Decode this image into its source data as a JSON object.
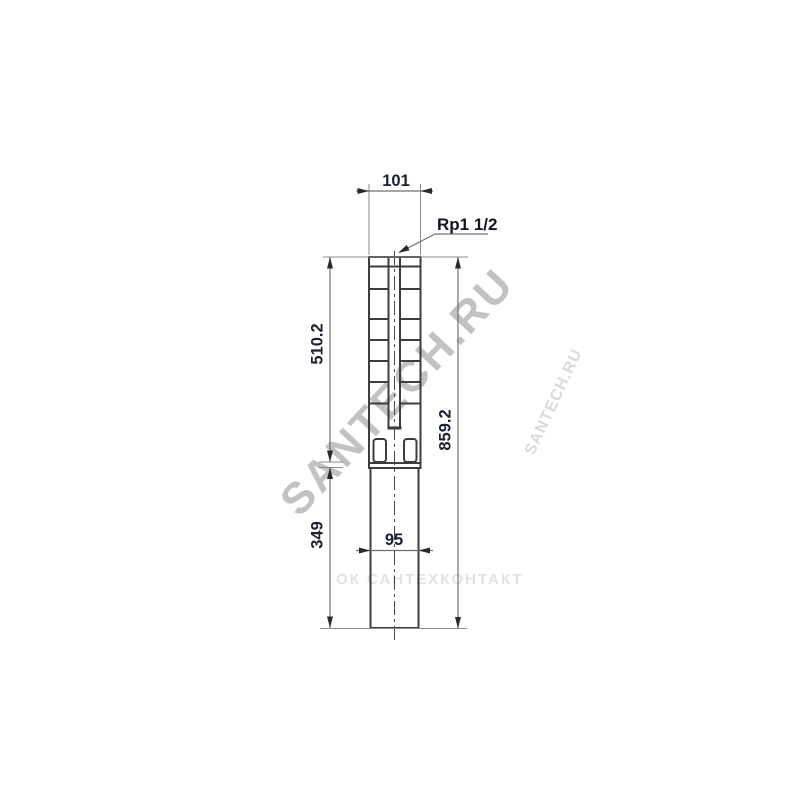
{
  "drawing": {
    "title": "submersible pump dimensional drawing",
    "labels": {
      "top_width": "101",
      "connection": "Rp1 1/2",
      "upper_length": "510.2",
      "lower_length": "349",
      "total_length": "859.2",
      "motor_width": "95"
    },
    "watermarks": {
      "main": "SANTECH.RU",
      "secondary": "SANTECH.RU",
      "horizontal": "ОК САНТЕХКОНТАКТ"
    },
    "colors": {
      "background": "#ffffff",
      "outline": "#3d3d3d",
      "dimension_line": "#707070",
      "extension_line": "#8c8c8c",
      "dimension_text": "#1c2130",
      "watermark_main": "#c2c2c2",
      "watermark_faint": "#e2e2e2"
    }
  }
}
